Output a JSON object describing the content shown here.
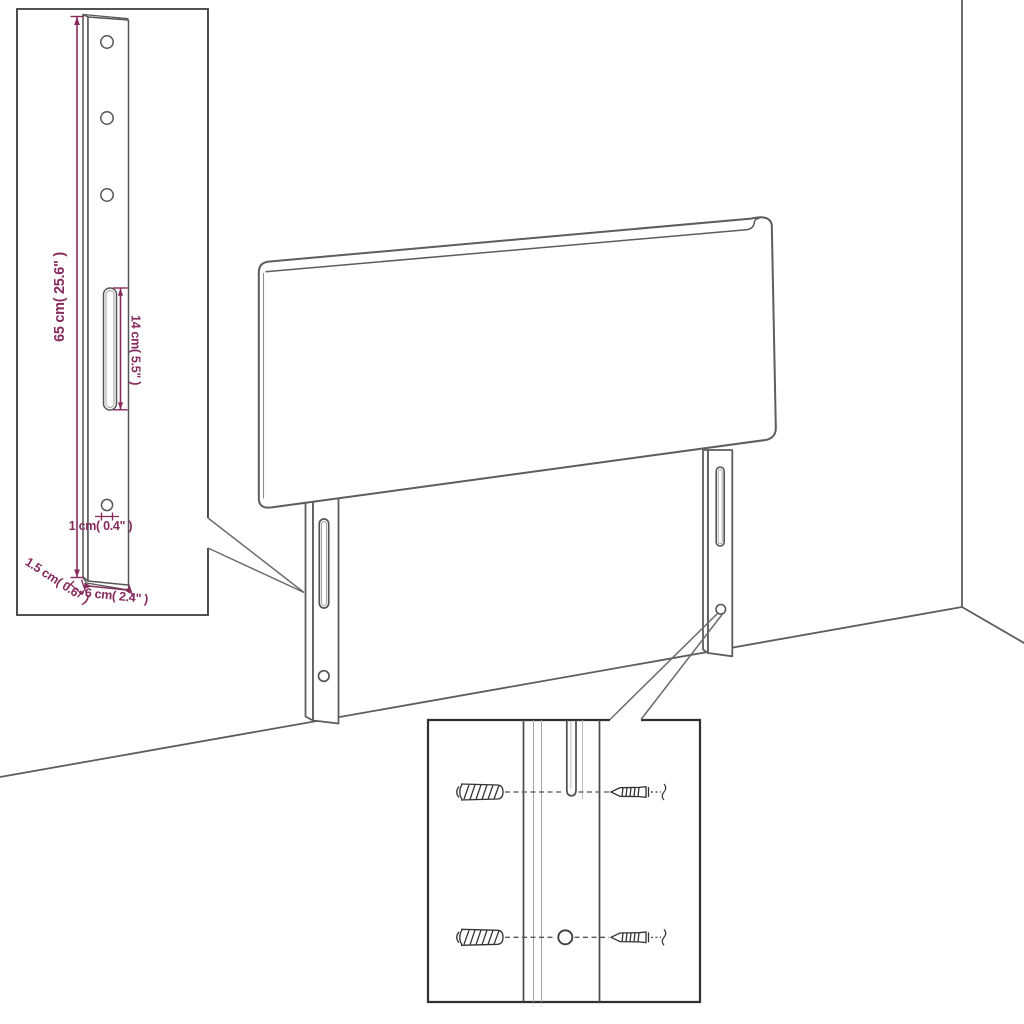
{
  "page": {
    "background": "#ffffff",
    "description": "Technical dimension diagram of an upholstered headboard with two slotted mounting legs, a zoom inset of one leg with measurements, and a zoom inset of wall-plug and screw mounting hardware."
  },
  "diagram": {
    "line_color": "#5d5d5d",
    "inset_border_color": "#3a3a3a",
    "dimension_color": "#862b5d",
    "dimensions": {
      "leg_height": "65 cm( 25.6\" )",
      "slot_length": "14 cm( 5.5\" )",
      "hole_diameter": "1 cm( 0.4\" )",
      "leg_thickness": "1.5 cm( 0.6\" )",
      "leg_width": "6 cm( 2.4\" )"
    },
    "insets": {
      "top_left": "leg detail with dimensions",
      "bottom_center": "wall plug and screw mounting detail"
    }
  }
}
